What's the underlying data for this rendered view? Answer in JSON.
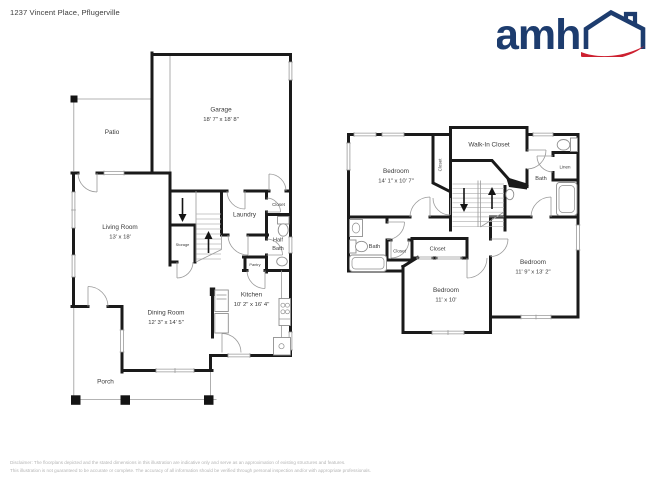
{
  "header": {
    "address": "1237 Vincent Place, Pflugerville",
    "logo_text": "amh"
  },
  "first_floor": {
    "patio": {
      "name": "Patio"
    },
    "garage": {
      "name": "Garage",
      "dims": "18' 7\" x 18' 8\""
    },
    "living_room": {
      "name": "Living Room",
      "dims": "13' x 18'"
    },
    "storage": {
      "name": "Storage"
    },
    "laundry": {
      "name": "Laundry"
    },
    "closet": {
      "name": "Closet"
    },
    "half_bath": {
      "line1": "Half",
      "line2": "Bath"
    },
    "pantry": {
      "name": "Pantry"
    },
    "kitchen": {
      "name": "Kitchen",
      "dims": "10' 2\" x 16' 4\""
    },
    "dining_room": {
      "name": "Dining Room",
      "dims": "12' 3\" x 14' 5\""
    },
    "porch": {
      "name": "Porch"
    }
  },
  "second_floor": {
    "bedroom1": {
      "name": "Bedroom",
      "dims": "14' 1\" x 10' 7\""
    },
    "closet_bedroom1": {
      "name": "Closet"
    },
    "walk_in_closet": {
      "name": "Walk-In Closet"
    },
    "linen": {
      "name": "Linen"
    },
    "bath_right": {
      "name": "Bath"
    },
    "bath_left": {
      "name": "Bath"
    },
    "closet_left": {
      "name": "Closet"
    },
    "closet_middle": {
      "name": "Closet"
    },
    "bedroom2": {
      "name": "Bedroom",
      "dims": "11' x 10'"
    },
    "bedroom3": {
      "name": "Bedroom",
      "dims": "11' 9\" x 13' 2\""
    }
  },
  "footer": {
    "line1": "Disclaimer: The floorplans depicted and the stated dimensions in this illustration are indicative only and serve as an approximation of existing structures and features.",
    "line2": "This illustration is not guaranteed to be accurate or complete. The accuracy of all information should be verified through personal inspection and/or with appropriate professionals."
  },
  "colors": {
    "wall": "#1a1a1a",
    "fixture": "#9a9a9a",
    "logo_navy": "#1d3c6e",
    "logo_red": "#cd2030"
  }
}
